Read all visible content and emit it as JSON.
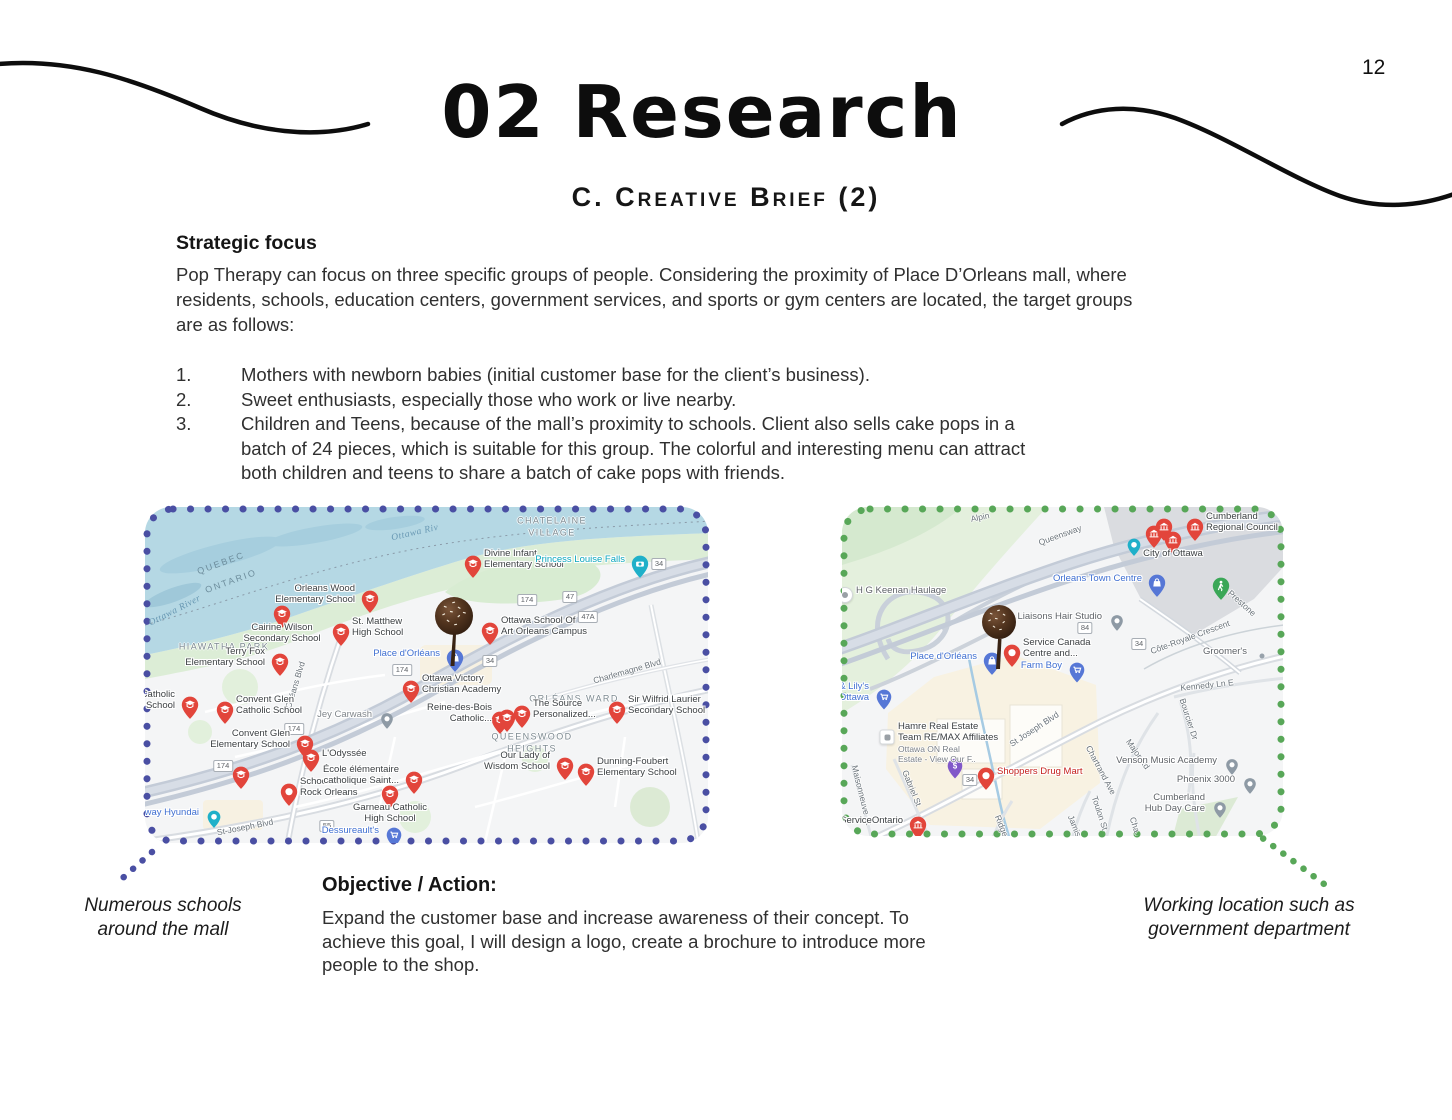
{
  "page": {
    "number": "12"
  },
  "header": {
    "title": "02 Research",
    "subtitle": "C. Creative Brief (2)"
  },
  "decor": {
    "line_color": "#0d0d0d"
  },
  "strategic": {
    "heading": "Strategic focus",
    "body": "Pop Therapy can focus on three specific groups of people. Considering the proximity of Place D’Orleans mall, where\nresidents, schools, education centers, government services, and sports or gym centers are located, the target groups\nare as follows:",
    "items": [
      {
        "num": "1.",
        "text": "Mothers with newborn babies (initial customer base for the client’s business)."
      },
      {
        "num": "2.",
        "text": "Sweet enthusiasts, especially those who work or live nearby."
      },
      {
        "num": "3.",
        "text": "Children and Teens, because of the mall’s proximity to schools. Client also sells cake pops in a\nbatch of 24 pieces, which is suitable for this group. The colorful and interesting menu can attract\nboth children and teens to share a batch of cake pops with friends."
      }
    ]
  },
  "objective": {
    "heading": "Objective / Action:",
    "body": "Expand the customer base and increase awareness of their concept. To\nachieve this goal, I will design a logo, create a brochure to introduce more\npeople to the shop."
  },
  "captions": {
    "left": "Numerous schools\naround the mall",
    "right": "Working location such as\ngovernment department"
  },
  "marker_colors": {
    "red": "#e2453b",
    "teal": "#1fb0c9",
    "blue": "#5677d6",
    "green": "#3aa757",
    "purple": "#8158c9",
    "gray": "#8e9aa5"
  },
  "maps": {
    "left": {
      "width": 567,
      "height": 340,
      "border_color": "#4a4fa3",
      "region_labels": [
        {
          "text": "CHATELAINE\nVILLAGE",
          "x": 407,
          "y": 20
        },
        {
          "text": "HIAWATHA PARK",
          "x": 79,
          "y": 140
        },
        {
          "text": "ORLÉANS WARD",
          "x": 429,
          "y": 192
        },
        {
          "text": "QUEENSWOOD\nHEIGHTS",
          "x": 387,
          "y": 236
        }
      ],
      "water_labels": [
        {
          "text": "QUEBEC",
          "x": 76,
          "y": 56,
          "rot": -20
        },
        {
          "text": "ONTARIO",
          "x": 86,
          "y": 74,
          "rot": -20
        },
        {
          "text": "Ottawa River",
          "x": 30,
          "y": 104,
          "rot": -27,
          "italic": true
        },
        {
          "text": "Ottawa Riv",
          "x": 270,
          "y": 26,
          "rot": -13,
          "italic": true
        }
      ],
      "street_labels": [
        {
          "text": "Orléans Blvd",
          "x": 150,
          "y": 178,
          "rot": -73
        },
        {
          "text": "Charlemagne Blvd",
          "x": 482,
          "y": 164,
          "rot": -16
        },
        {
          "text": "St-Joseph Blvd",
          "x": 100,
          "y": 320,
          "rot": -11
        }
      ],
      "route_shields": [
        {
          "text": "174",
          "x": 382,
          "y": 93
        },
        {
          "text": "47",
          "x": 425,
          "y": 90
        },
        {
          "text": "47A",
          "x": 443,
          "y": 110
        },
        {
          "text": "34",
          "x": 345,
          "y": 154
        },
        {
          "text": "174",
          "x": 257,
          "y": 163
        },
        {
          "text": "174",
          "x": 149,
          "y": 222
        },
        {
          "text": "174",
          "x": 78,
          "y": 259
        },
        {
          "text": "55",
          "x": 182,
          "y": 319
        },
        {
          "text": "34",
          "x": 514,
          "y": 57
        }
      ],
      "pois": [
        {
          "label": "Divine Infant\nElementary School",
          "x": 328,
          "y": 57,
          "type": "school",
          "side": "right"
        },
        {
          "label": "Princess Louise Falls",
          "x": 495,
          "y": 57,
          "type": "camera",
          "side": "left",
          "color": "#09a6bd"
        },
        {
          "label": "Orleans Wood\nElementary School",
          "x": 225,
          "y": 92,
          "type": "school",
          "side": "left"
        },
        {
          "label": "Cairine Wilson\nSecondary School",
          "x": 137,
          "y": 107,
          "type": "school",
          "side": "below"
        },
        {
          "label": "St. Matthew\nHigh School",
          "x": 196,
          "y": 125,
          "type": "school",
          "side": "right"
        },
        {
          "label": "Terry Fox\nElementary School",
          "x": 135,
          "y": 155,
          "type": "school",
          "side": "left"
        },
        {
          "label": "Ottawa School Of\nArt Orleans Campus",
          "x": 345,
          "y": 124,
          "type": "school",
          "side": "right"
        },
        {
          "label": "Place d'Orléans",
          "x": 310,
          "y": 151,
          "type": "mallblue",
          "side": "left",
          "color": "#3f6fd1"
        },
        {
          "label": "Ottawa Victory\nChristian Academy",
          "x": 266,
          "y": 182,
          "type": "school",
          "side": "right"
        },
        {
          "label": "Catholic\ny School",
          "x": 45,
          "y": 198,
          "type": "school",
          "side": "left"
        },
        {
          "label": "Convent Glen\nCatholic School",
          "x": 80,
          "y": 203,
          "type": "school",
          "side": "right"
        },
        {
          "label": "Jey Carwash",
          "x": 242,
          "y": 212,
          "type": "gray",
          "side": "left",
          "color": "#80868b"
        },
        {
          "label": "Convent Glen\nElementary School",
          "x": 160,
          "y": 237,
          "type": "school",
          "side": "left"
        },
        {
          "label": "L'Odyssée",
          "x": 166,
          "y": 251,
          "type": "school",
          "side": "right"
        },
        {
          "label": "",
          "x": 96,
          "y": 268,
          "type": "school",
          "side": "none"
        },
        {
          "label": "School of\nRock Orleans",
          "x": 144,
          "y": 285,
          "type": "red",
          "side": "right"
        },
        {
          "label": "Garneau Catholic\nHigh School",
          "x": 245,
          "y": 287,
          "type": "school",
          "side": "below"
        },
        {
          "label": "École élémentaire\ncatholique Saint...",
          "x": 269,
          "y": 273,
          "type": "school",
          "side": "left"
        },
        {
          "label": "hway Hyundai",
          "x": 69,
          "y": 310,
          "type": "tealdot",
          "side": "left",
          "color": "#3f6fd1"
        },
        {
          "label": "Dessureault's",
          "x": 249,
          "y": 328,
          "type": "bluecart",
          "side": "left",
          "color": "#3f6fd1"
        },
        {
          "label": "",
          "x": 355,
          "y": 213,
          "type": "school",
          "side": "none"
        },
        {
          "label": "Reine-des-Bois\nCatholic...",
          "x": 362,
          "y": 211,
          "type": "school",
          "side": "left"
        },
        {
          "label": "The Source\nPersonalized...",
          "x": 377,
          "y": 207,
          "type": "school",
          "side": "right"
        },
        {
          "label": "Sir Wilfrid Laurier\nSecondary School",
          "x": 472,
          "y": 203,
          "type": "school",
          "side": "right"
        },
        {
          "label": "Our Lady of\nWisdom School",
          "x": 420,
          "y": 259,
          "type": "school",
          "side": "left"
        },
        {
          "label": "Dunning-Foubert\nElementary School",
          "x": 441,
          "y": 265,
          "type": "school",
          "side": "right"
        }
      ]
    },
    "right": {
      "width": 445,
      "height": 333,
      "border_color": "#58a758",
      "region_labels": [],
      "water_labels": [],
      "street_labels": [
        {
          "text": "Alpin",
          "x": 138,
          "y": 10,
          "rot": -12
        },
        {
          "text": "Queensway",
          "x": 218,
          "y": 28,
          "rot": -20
        },
        {
          "text": "Prestone",
          "x": 400,
          "y": 96,
          "rot": 42
        },
        {
          "text": "Côte-Royale Crescent",
          "x": 348,
          "y": 130,
          "rot": -20
        },
        {
          "text": "Kennedy Ln E",
          "x": 365,
          "y": 178,
          "rot": -6
        },
        {
          "text": "Bourcier Dr",
          "x": 347,
          "y": 212,
          "rot": 72
        },
        {
          "text": "Major Rd",
          "x": 296,
          "y": 247,
          "rot": 55
        },
        {
          "text": "St Joseph Blvd",
          "x": 192,
          "y": 222,
          "rot": -33
        },
        {
          "text": "Chartrand Ave",
          "x": 259,
          "y": 263,
          "rot": 62
        },
        {
          "text": "Maisonneuve St",
          "x": 20,
          "y": 288,
          "rot": 76
        },
        {
          "text": "Gabriel St",
          "x": 70,
          "y": 281,
          "rot": 68
        },
        {
          "text": "Toulon St",
          "x": 258,
          "y": 306,
          "rot": 72
        },
        {
          "text": "Jamis...",
          "x": 234,
          "y": 322,
          "rot": 68
        },
        {
          "text": "Ridge...",
          "x": 161,
          "y": 322,
          "rot": 68
        },
        {
          "text": "Cha...",
          "x": 294,
          "y": 321,
          "rot": 72
        }
      ],
      "route_shields": [
        {
          "text": "84",
          "x": 243,
          "y": 121
        },
        {
          "text": "34",
          "x": 297,
          "y": 137
        },
        {
          "text": "34",
          "x": 128,
          "y": 273
        }
      ],
      "pois": [
        {
          "label": "H G Keenan Haulage",
          "x": 3,
          "y": 88,
          "type": "whitecircle",
          "side": "right",
          "color": "#5f6368"
        },
        {
          "label": "Orleans Town Centre",
          "x": 315,
          "y": 76,
          "type": "mallblue",
          "side": "left",
          "color": "#3f6fd1"
        },
        {
          "label": "Liaisons Hair Studio",
          "x": 275,
          "y": 114,
          "type": "gray",
          "side": "left",
          "color": "#5f6368"
        },
        {
          "label": "",
          "x": 312,
          "y": 27,
          "type": "gov",
          "side": "none"
        },
        {
          "label": "",
          "x": 322,
          "y": 20,
          "type": "gov",
          "side": "none"
        },
        {
          "label": "City of Ottawa",
          "x": 331,
          "y": 33,
          "type": "gov",
          "side": "below"
        },
        {
          "label": "",
          "x": 292,
          "y": 38,
          "type": "tealdot",
          "side": "none"
        },
        {
          "label": "Cumberland\nRegional Council",
          "x": 353,
          "y": 20,
          "type": "gov",
          "side": "right"
        },
        {
          "label": "",
          "x": 379,
          "y": 79,
          "type": "greenped",
          "side": "none"
        },
        {
          "label": "Groomer's",
          "x": 420,
          "y": 149,
          "type": "tiny",
          "side": "left",
          "color": "#5f6368"
        },
        {
          "label": "Place d'Orléans",
          "x": 150,
          "y": 154,
          "type": "mallblue",
          "side": "left",
          "color": "#3f6fd1"
        },
        {
          "label": "Service Canada\nCentre and...",
          "x": 170,
          "y": 146,
          "type": "red",
          "side": "right"
        },
        {
          "label": "Farm Boy",
          "x": 235,
          "y": 163,
          "type": "bluecart",
          "side": "left",
          "color": "#3f6fd1"
        },
        {
          "label": "e & Lily's\nS Ottawa",
          "x": 42,
          "y": 190,
          "type": "bluecart",
          "side": "left",
          "color": "#3f6fd1"
        },
        {
          "label": "Hamre Real Estate\nTeam RE/MAX Affiliates",
          "x": 45,
          "y": 230,
          "type": "whitesq",
          "side": "right",
          "sub": "Ottawa ON Real\nEstate - View Our F.."
        },
        {
          "label": "",
          "x": 113,
          "y": 259,
          "type": "purple",
          "side": "none"
        },
        {
          "label": "Shoppers Drug Mart",
          "x": 144,
          "y": 269,
          "type": "red",
          "side": "right",
          "color": "#c5221f"
        },
        {
          "label": "ServiceOntario",
          "x": 76,
          "y": 318,
          "type": "gov",
          "side": "left",
          "color": "#3c4043"
        },
        {
          "label": "Venson Music Academy",
          "x": 390,
          "y": 258,
          "type": "gray",
          "side": "left",
          "color": "#5f6368"
        },
        {
          "label": "Phoenix 3000",
          "x": 408,
          "y": 277,
          "type": "gray",
          "side": "left",
          "color": "#5f6368"
        },
        {
          "label": "Cumberland\nHub Day Care",
          "x": 378,
          "y": 301,
          "type": "gray",
          "side": "left",
          "color": "#5f6368"
        }
      ]
    }
  }
}
